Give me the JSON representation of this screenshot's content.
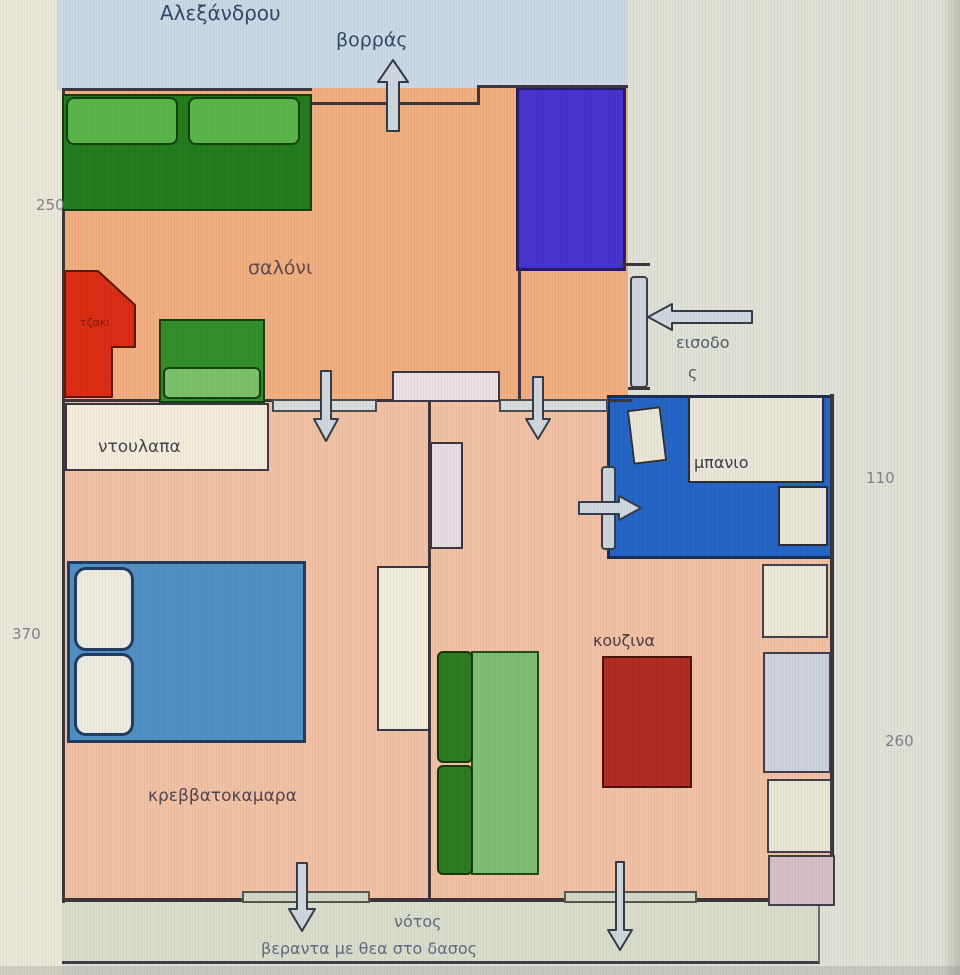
{
  "plan": {
    "street_label": "Αλεξάνδρου",
    "compass": {
      "north": "βορράς",
      "south": "νότος"
    },
    "veranda_label": "βεραντα με θεα στο δασος",
    "rooms": {
      "living_room": "σαλόνι",
      "fireplace": "τζακι",
      "wardrobe": "ντουλαπα",
      "bedroom": "κρεββατοκαμαρα",
      "kitchen": "κουζινα",
      "bathroom": "μπανιο",
      "entrance_line1": "εισοδο",
      "entrance_line2": "ς"
    },
    "dimensions": {
      "north": "250",
      "west": "370",
      "east_upper": "110",
      "east_lower": "260"
    },
    "colors": {
      "street": "#c9d8e3",
      "living_room": "#f0ad7e",
      "bedroom_kitchen": "#f1c0a2",
      "bathroom": "#2163c4",
      "closet": "#4531ce",
      "bed": "#4e8fc4",
      "sofa_dark": "#1e7a1a",
      "sofa_light": "#57b545",
      "fireplace": "#da2a10",
      "kitchen_counter": "#ae291d",
      "veranda": "#d8dcc9",
      "background": "#dfe1d5"
    }
  }
}
